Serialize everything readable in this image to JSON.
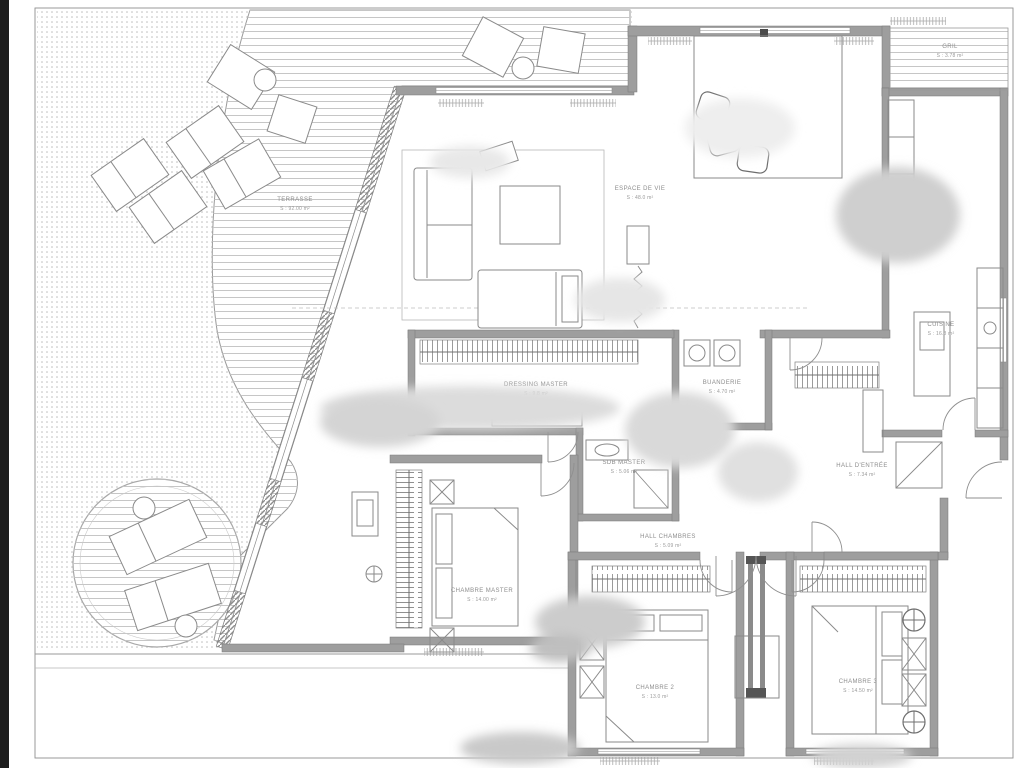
{
  "document": {
    "kind": "architectural floor plan",
    "style": "black and white blueprint scan with blurred watermark patches"
  },
  "rooms": [
    {
      "id": "terrasse",
      "name": "TERRASSE",
      "area": "S : 92.00 m²"
    },
    {
      "id": "espace-de-vie",
      "name": "ESPACE DE VIE",
      "area": "S : 48.0 m²"
    },
    {
      "id": "gril",
      "name": "GRIL",
      "area": "S : 3.78 m²"
    },
    {
      "id": "cuisine",
      "name": "CUISINE",
      "area": "S : 16.8 m²"
    },
    {
      "id": "buanderie",
      "name": "BUANDERIE",
      "area": "S : 4.70 m²"
    },
    {
      "id": "dressing-master",
      "name": "DRESSING MASTER",
      "area": "S : 9.8 m²"
    },
    {
      "id": "sdb-master",
      "name": "SDB MASTER",
      "area": "S : 5.06 m²"
    },
    {
      "id": "hall-entree",
      "name": "HALL D'ENTRÉE",
      "area": "S : 7.34 m²"
    },
    {
      "id": "hall-chambres",
      "name": "HALL CHAMBRES",
      "area": "S : 5.09 m²"
    },
    {
      "id": "chambre-master",
      "name": "CHAMBRE MASTER",
      "area": "S : 14.00 m²"
    },
    {
      "id": "chambre-2",
      "name": "CHAMBRE 2",
      "area": "S : 13.0 m²"
    },
    {
      "id": "chambre-3",
      "name": "CHAMBRE 3",
      "area": "S : 14.50 m²"
    }
  ],
  "colors": {
    "walls": "#9e9e9e",
    "deck_lines": "#c6c6c6",
    "stipple": "#bcbcbc",
    "labels": "#8d8d8d",
    "paper": "#ffffff"
  }
}
